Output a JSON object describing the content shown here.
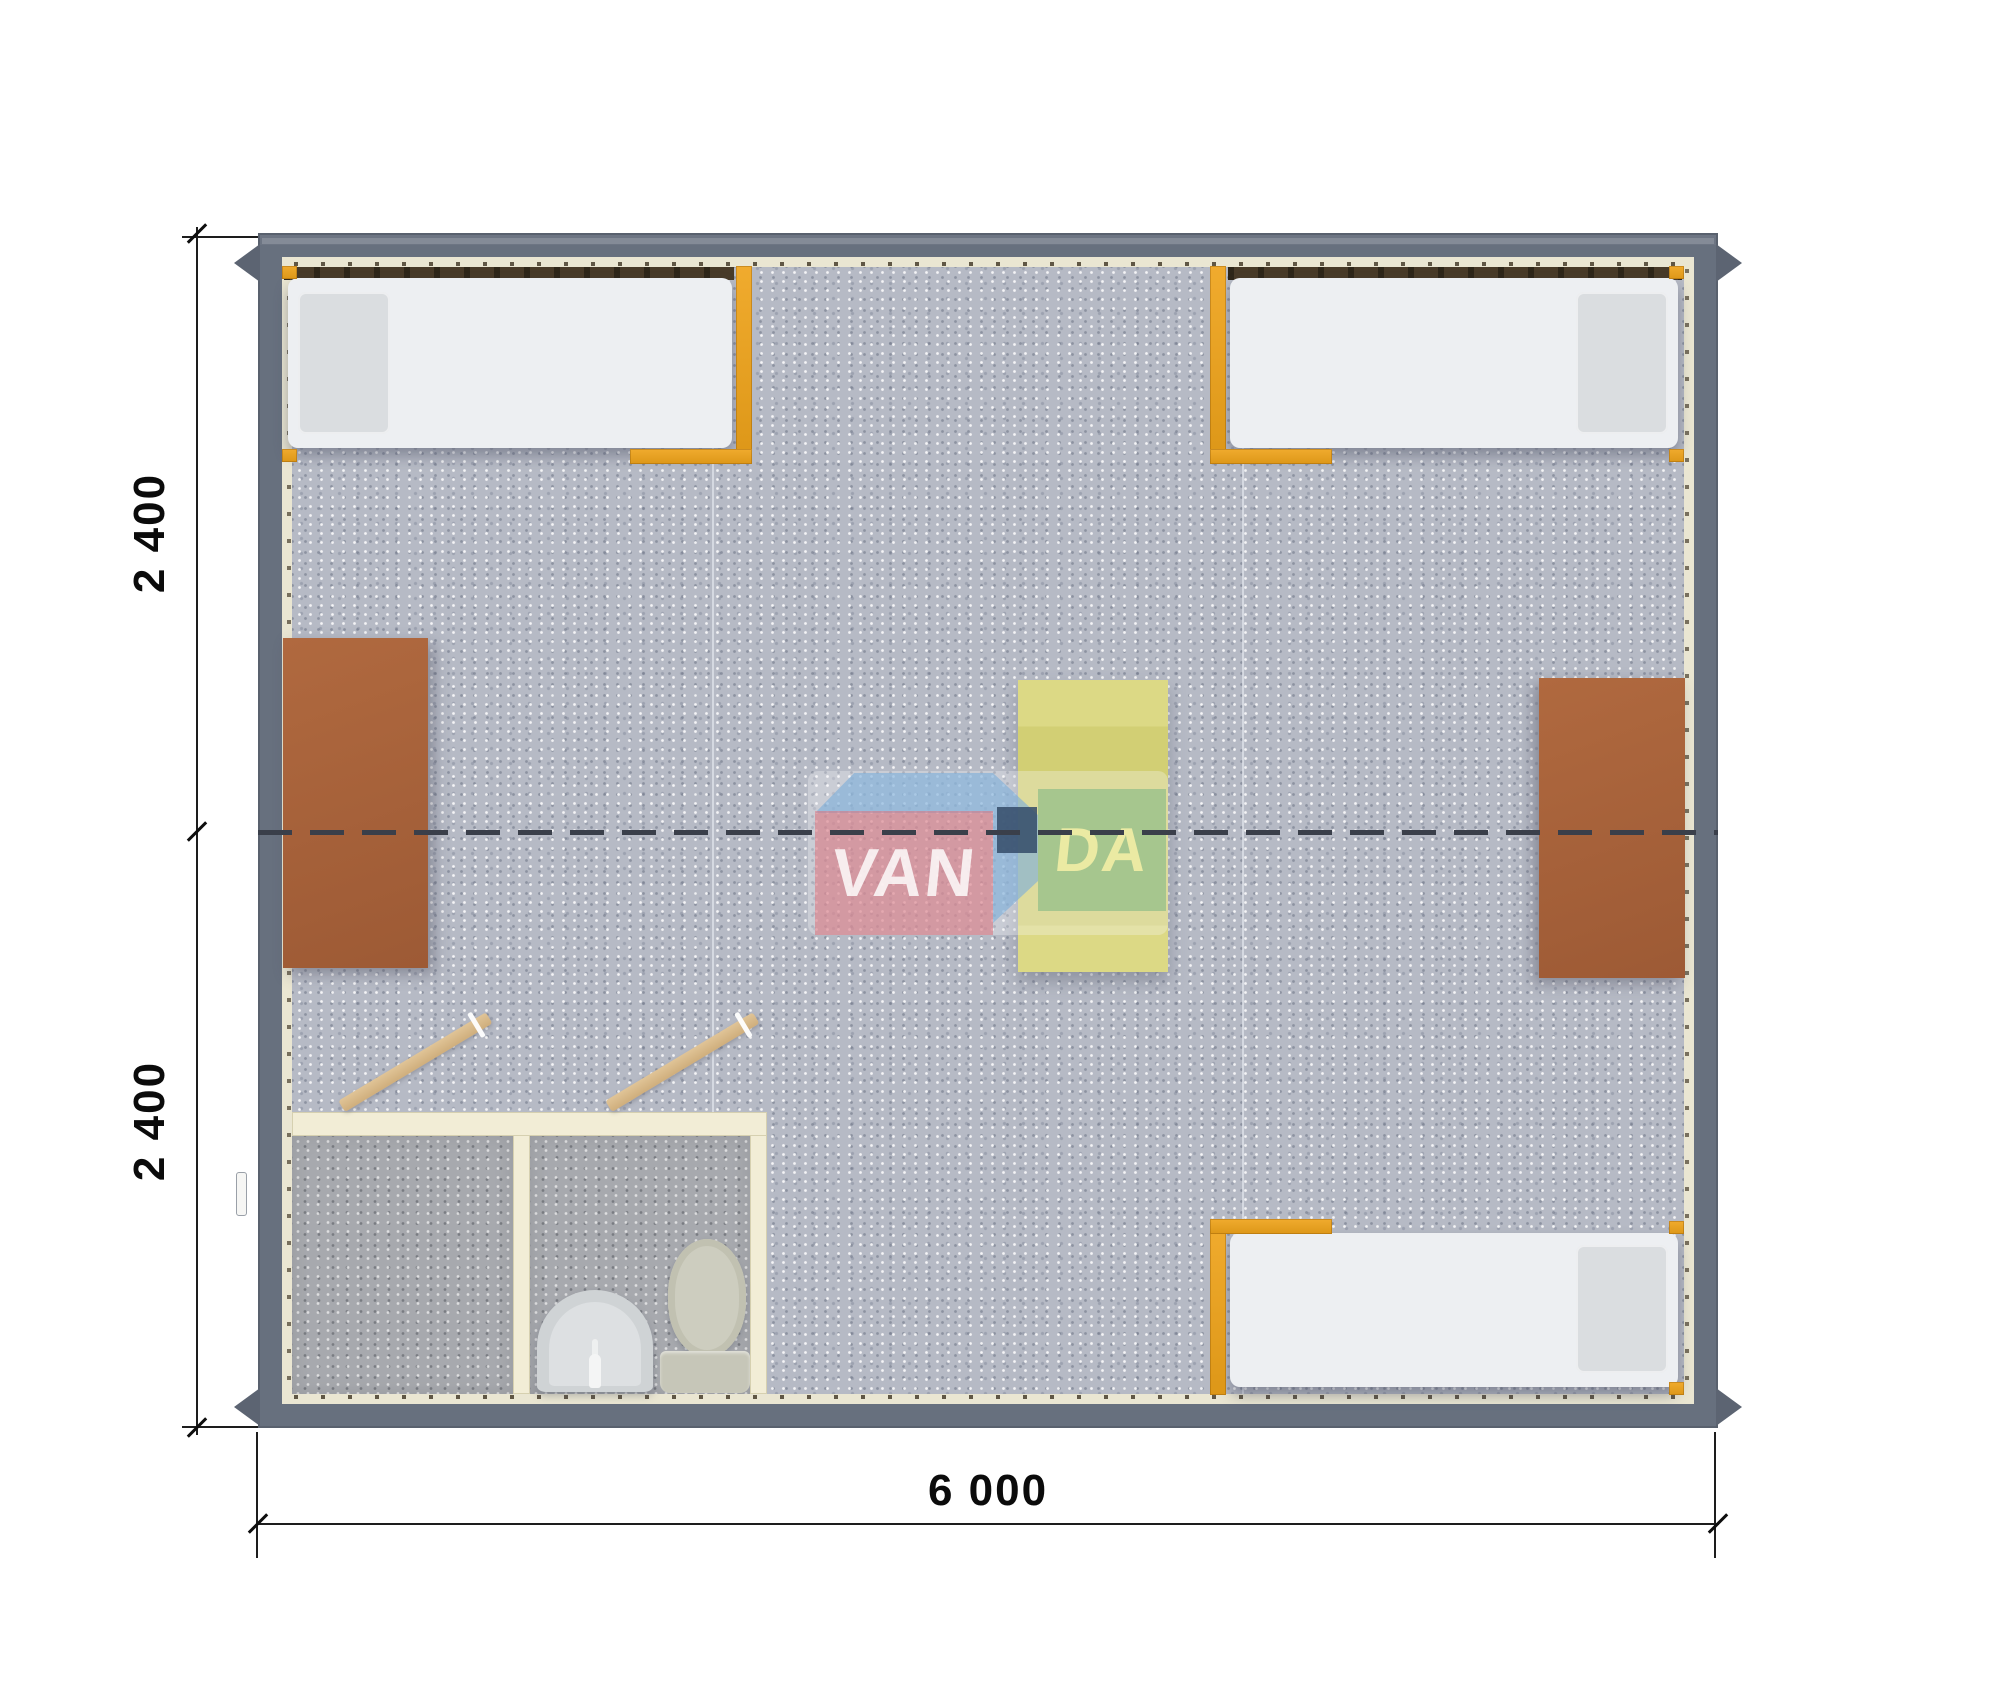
{
  "title": "Modular building floor plan, top view",
  "dimensions": {
    "left_upper": "2 400",
    "left_lower": "2 400",
    "bottom_width": "6 000"
  },
  "watermark": {
    "text_left": "VAN",
    "text_right": "DA"
  },
  "furniture": {
    "beds": [
      "bed-top-left",
      "bed-top-right",
      "bed-bottom-right"
    ],
    "desks": [
      "desk-left-wall",
      "desk-right-wall"
    ],
    "table": "table-center",
    "bathroom": [
      "shower-room",
      "wc-room",
      "sink",
      "toilet",
      "interior-door",
      "interior-door"
    ]
  },
  "colors": {
    "wall": "#67707e",
    "wall_liner": "#eae6d2",
    "carpet": "#b6bac5",
    "bathroom_floor": "#a7a9ae",
    "bed_mattress": "#edeff2",
    "bed_frame_orange": "#e8a226",
    "desk_brown": "#a7603b",
    "table_yellow": "#d5d27b",
    "partition_cream": "#f2edd6",
    "door_wood": "#d8bb8d",
    "module_split_line": "#3a3f4a",
    "watermark_pink": "#d87680",
    "watermark_blue": "#7dafda",
    "watermark_green": "#78b482",
    "watermark_navy": "#34506e"
  }
}
